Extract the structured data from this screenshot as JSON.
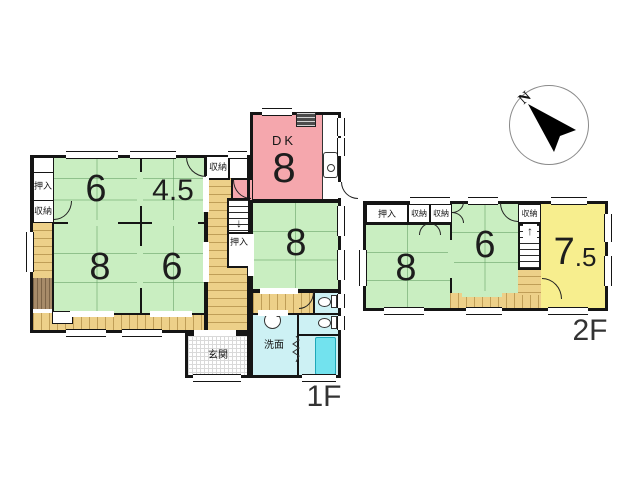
{
  "compass": {
    "north": "N"
  },
  "colors": {
    "tatami_green": "#c9eec1",
    "dk_pink": "#f5a7ad",
    "western_yellow": "#f7ee8e",
    "wet_blue": "#cdf1f4",
    "corridor_tan": "#edd089",
    "tub_cyan": "#72e2ee"
  },
  "floor1": {
    "label": "1F",
    "dk": {
      "name": "DK",
      "size": "8"
    },
    "rooms": [
      {
        "size": "6"
      },
      {
        "size": "4.5"
      },
      {
        "size": "8"
      },
      {
        "size": "6"
      },
      {
        "size": "8"
      }
    ],
    "closets": {
      "oshiire_left": "押入",
      "shuunou_left": "収納",
      "shuunou_mid": "収納",
      "oshiire_under_stairs": "押入"
    },
    "entrance_label": "玄関",
    "washroom_label": "洗面",
    "stairs_arrow": "↓"
  },
  "floor2": {
    "label": "2F",
    "rooms": [
      {
        "size": "8"
      },
      {
        "size": "6"
      },
      {
        "size_big": "7",
        "size_small": ".5"
      }
    ],
    "closets": {
      "oshiire": "押入",
      "shuunou_1": "収納",
      "shuunou_2": "収納",
      "shuunou_right": "収納"
    },
    "stairs_arrow": "↑"
  }
}
